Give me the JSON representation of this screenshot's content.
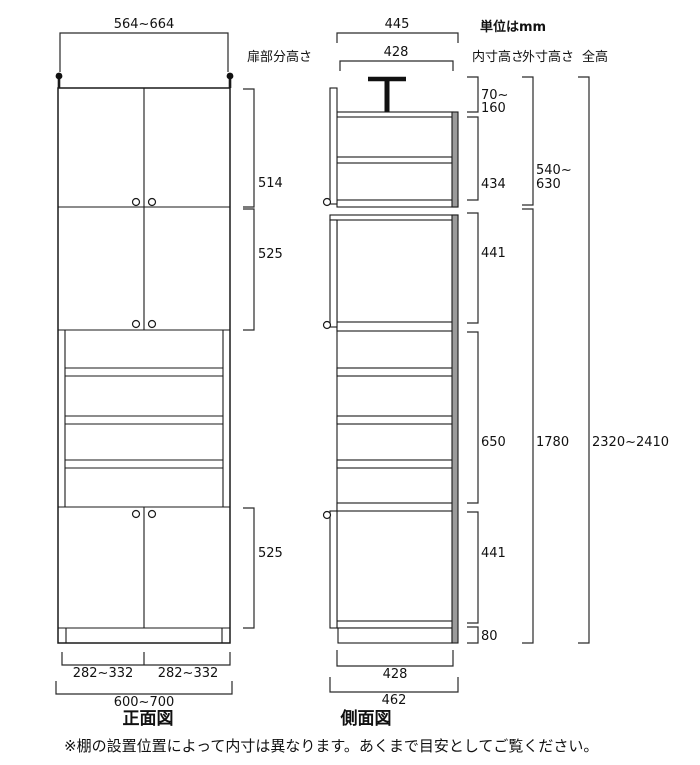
{
  "unit_label": "単位はmm",
  "front_view": {
    "title": "正面図",
    "top_width": "564~664",
    "door_label": "扉部分高さ",
    "upper_door_height": "514",
    "middle_door_height": "525",
    "lower_door_height": "525",
    "left_door_width": "282~332",
    "right_door_width": "282~332",
    "total_width": "600~700"
  },
  "side_view": {
    "title": "側面図",
    "top_outer_depth": "445",
    "top_inner_depth": "428",
    "bottom_inner_depth": "428",
    "total_depth": "462"
  },
  "height_columns": {
    "inner_header": "内寸高さ",
    "outer_header": "外寸高さ",
    "overall_header": "全高",
    "ceiling_gap_line1": "70~",
    "ceiling_gap_line2": "160",
    "upper_inner": "434",
    "upper_mid_inner": "441",
    "open_inner": "650",
    "lower_mid_inner": "441",
    "base_height": "80",
    "upper_outer_line1": "540~",
    "upper_outer_line2": "630",
    "main_outer": "1780",
    "overall_height": "2320~2410"
  },
  "footnote": "※棚の設置位置によって内寸は異なります。あくまで目安としてご覧ください。"
}
